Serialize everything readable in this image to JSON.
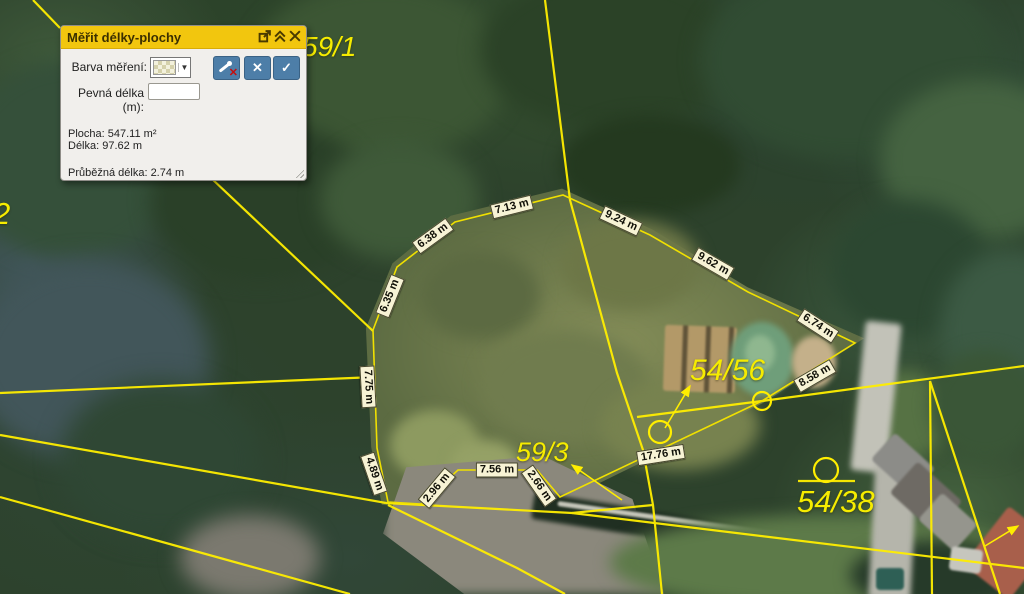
{
  "panel": {
    "title": "Měřit délky-plochy",
    "titlebar_icons": [
      "popout-icon",
      "collapse-icon",
      "close-icon"
    ],
    "controls": {
      "color_label": "Barva měření:",
      "color_swatch": "checkered-pattern-swatch",
      "dropdown_arrow": "▼",
      "fixed_length_label": "Pevná délka (m):",
      "fixed_length_value": "",
      "buttons": [
        {
          "name": "remove-last-point-button",
          "icon": "measure-pin-with-red-x"
        },
        {
          "name": "cancel-measurement-button",
          "icon": "✕"
        },
        {
          "name": "finish-measurement-button",
          "icon": "✓"
        }
      ]
    },
    "results": {
      "area_label": "Plocha:",
      "area_value": "547.11 m²",
      "length_label": "Délka:",
      "length_value": "97.62 m",
      "running_label": "Průběžná délka:",
      "running_value": "2.74 m"
    },
    "colors": {
      "titlebar": "#f2c60e",
      "body": "#f1efec",
      "button_blue": "#4d7ea8",
      "accent_red": "#c40f0f"
    }
  },
  "map": {
    "line_color": "#ffee00",
    "measurement_line_color": "#f0e000",
    "dimension_labels": [
      {
        "text": "6.38 m",
        "x": 433,
        "y": 236,
        "rot": -36
      },
      {
        "text": "7.13 m",
        "x": 512,
        "y": 207,
        "rot": -14
      },
      {
        "text": "9.24 m",
        "x": 621,
        "y": 221,
        "rot": 25
      },
      {
        "text": "9.62 m",
        "x": 713,
        "y": 264,
        "rot": 30
      },
      {
        "text": "6.74 m",
        "x": 818,
        "y": 326,
        "rot": 33
      },
      {
        "text": "8.58 m",
        "x": 815,
        "y": 376,
        "rot": -30
      },
      {
        "text": "17.76 m",
        "x": 661,
        "y": 455,
        "rot": -9
      },
      {
        "text": "2.66 m",
        "x": 539,
        "y": 486,
        "rot": 55
      },
      {
        "text": "7.56 m",
        "x": 497,
        "y": 470,
        "rot": 0
      },
      {
        "text": "2.96 m",
        "x": 437,
        "y": 488,
        "rot": -50
      },
      {
        "text": "4.89 m",
        "x": 374,
        "y": 474,
        "rot": 71
      },
      {
        "text": "7.75 m",
        "x": 368,
        "y": 387,
        "rot": 87
      },
      {
        "text": "6.35 m",
        "x": 390,
        "y": 296,
        "rot": -68
      }
    ],
    "parcel_labels": [
      {
        "text": "59/1",
        "x": 302,
        "y": 31,
        "size": 28
      },
      {
        "text": "2",
        "x": -7,
        "y": 196,
        "size": 31
      },
      {
        "text": "59/3",
        "x": 516,
        "y": 437,
        "size": 27
      },
      {
        "text": "54/56",
        "x": 690,
        "y": 354,
        "size": 30
      },
      {
        "text": "54/38",
        "x": 797,
        "y": 484,
        "size": 31
      }
    ]
  }
}
